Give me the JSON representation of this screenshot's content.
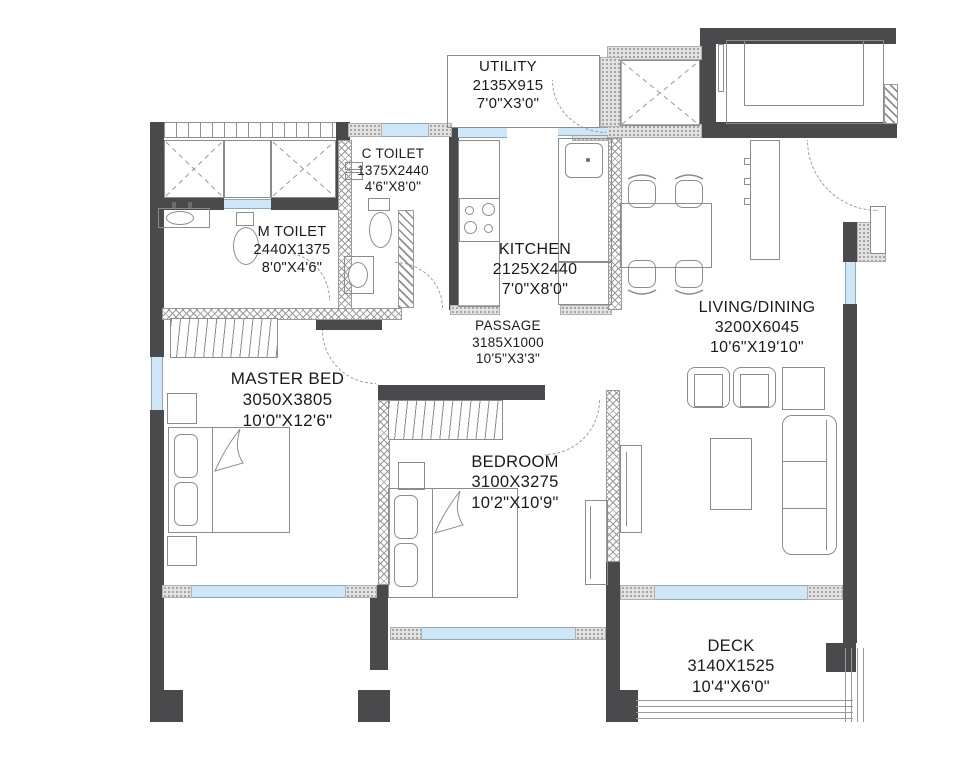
{
  "plan_title": "2 BHK Apartment Floor Plan",
  "rooms": {
    "utility": {
      "name": "UTILITY",
      "mm": "2135X915",
      "ft": "7'0\"X3'0\""
    },
    "c_toilet": {
      "name": "C TOILET",
      "mm": "1375X2440",
      "ft": "4'6\"X8'0\""
    },
    "m_toilet": {
      "name": "M TOILET",
      "mm": "2440X1375",
      "ft": "8'0\"X4'6\""
    },
    "kitchen": {
      "name": "KITCHEN",
      "mm": "2125X2440",
      "ft": "7'0\"X8'0\""
    },
    "living_dining": {
      "name": "LIVING/DINING",
      "mm": "3200X6045",
      "ft": "10'6\"X19'10\""
    },
    "passage": {
      "name": "PASSAGE",
      "mm": "3185X1000",
      "ft": "10'5\"X3'3\""
    },
    "master_bed": {
      "name": "MASTER BED",
      "mm": "3050X3805",
      "ft": "10'0\"X12'6\""
    },
    "bedroom": {
      "name": "BEDROOM",
      "mm": "3100X3275",
      "ft": "10'2\"X10'9\""
    },
    "deck": {
      "name": "DECK",
      "mm": "3140X1525",
      "ft": "10'4\"X6'0\""
    }
  },
  "colors": {
    "wall_dark": "#4a4a4c",
    "window_blue": "#cfe6f7",
    "line_gray": "#8c8c8c",
    "text": "#1a1a1a",
    "background": "#ffffff"
  }
}
